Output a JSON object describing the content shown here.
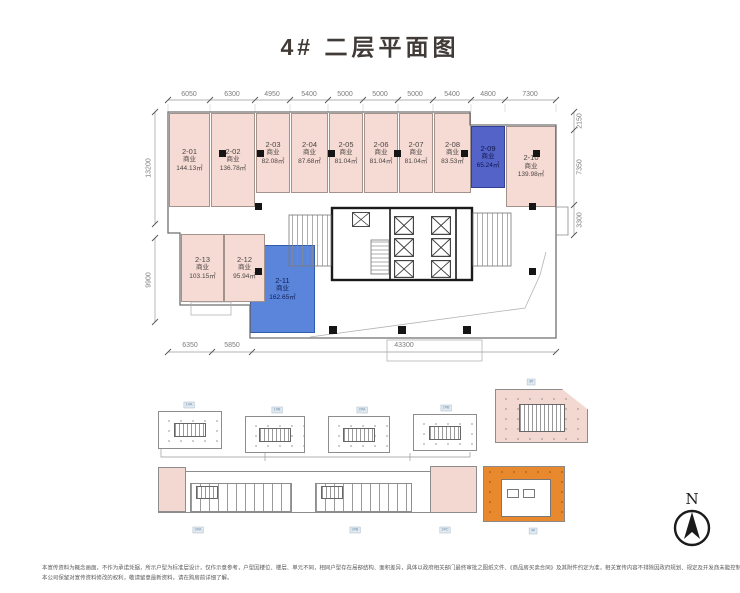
{
  "title": "4#  二层平面图",
  "plan": {
    "units": [
      {
        "id": "2-01",
        "type": "商业",
        "area": "144.13㎡",
        "highlight": false
      },
      {
        "id": "2-02",
        "type": "商业",
        "area": "136.78㎡",
        "highlight": false
      },
      {
        "id": "2-03",
        "type": "商业",
        "area": "82.08㎡",
        "highlight": false
      },
      {
        "id": "2-04",
        "type": "商业",
        "area": "87.68㎡",
        "highlight": false
      },
      {
        "id": "2-05",
        "type": "商业",
        "area": "81.04㎡",
        "highlight": false
      },
      {
        "id": "2-06",
        "type": "商业",
        "area": "81.04㎡",
        "highlight": false
      },
      {
        "id": "2-07",
        "type": "商业",
        "area": "81.04㎡",
        "highlight": false
      },
      {
        "id": "2-08",
        "type": "商业",
        "area": "83.53㎡",
        "highlight": false
      },
      {
        "id": "2-09",
        "type": "商业",
        "area": "65.24㎡",
        "highlight": true
      },
      {
        "id": "2-10",
        "type": "商业",
        "area": "139.98㎡",
        "highlight": false
      },
      {
        "id": "2-11",
        "type": "商业",
        "area": "162.65㎡",
        "highlight": true
      },
      {
        "id": "2-12",
        "type": "商业",
        "area": "95.94㎡",
        "highlight": false
      },
      {
        "id": "2-13",
        "type": "商业",
        "area": "103.15㎡",
        "highlight": false
      }
    ],
    "dimensions": {
      "top": [
        "6050",
        "6300",
        "4950",
        "5400",
        "5000",
        "5000",
        "5000",
        "5400",
        "4800",
        "7300"
      ],
      "left": [
        "13200",
        "9900"
      ],
      "right": [
        "2150",
        "7350",
        "3300"
      ],
      "bottom": [
        "6350",
        "5850",
        "43300"
      ]
    }
  },
  "thumbnails": {
    "row1": [
      "1#A",
      "1#B",
      "2#A",
      "2#B"
    ],
    "row2": [
      "3#A",
      "3#B",
      "3#C"
    ],
    "side_top": "3#",
    "side_bottom": "4#"
  },
  "compass": {
    "label": "N"
  },
  "disclaimer": {
    "line1": "本宣传资料为概念画面，不作为承诺凭据，所示户型为标准层设计，仅作示意参考，户型因楼位、楼层、单元不同，相同户型存在局部结构、面积差异，具体以政府相关部门最终审批之图纸文件、《商品房买卖合同》及其附件约定为准，相关宣传内容不排除因政府规划、规定及开发商未能控制的原因发生变化，",
    "line2": "本公司保留对宣传资料修改的权利，敬请留意最新资料，请在购房前详细了解。"
  },
  "colors": {
    "unit_fill": "#f6dbd5",
    "highlight_a": "#5463c8",
    "highlight_b": "#5b85da",
    "thumb_orange": "#e9892e",
    "thumb_pink": "#f3d8d2"
  }
}
